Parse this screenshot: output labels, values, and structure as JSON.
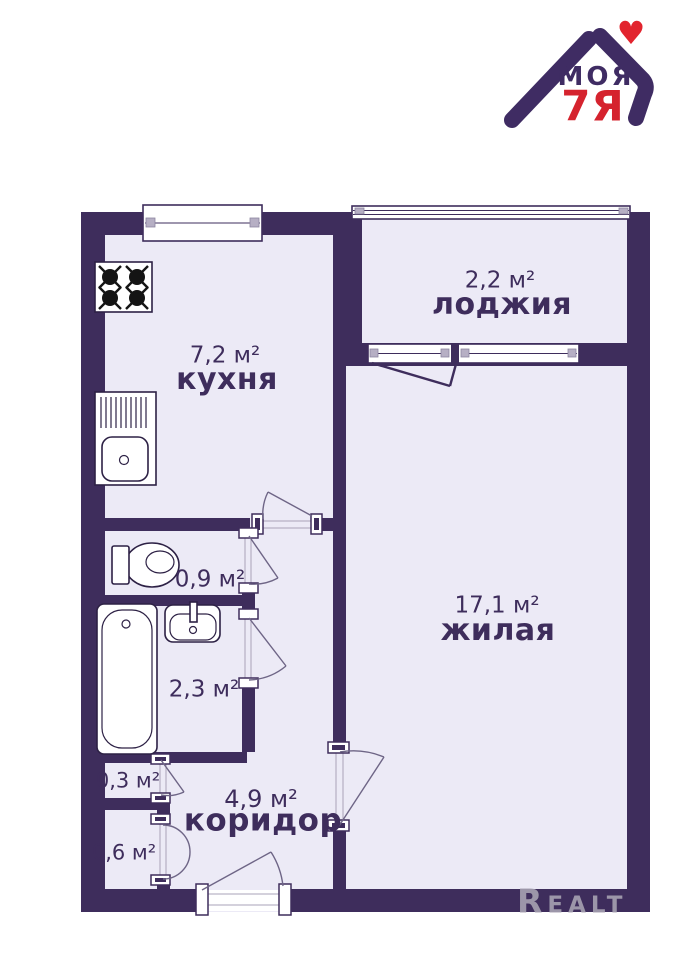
{
  "brand": {
    "word": "МОЯ",
    "mark": "7Я",
    "heart": "♥"
  },
  "watermark": {
    "text": "Realt"
  },
  "rooms": {
    "kitchen": {
      "area": "7,2 м²",
      "name": "кухня"
    },
    "loggia": {
      "area": "2,2 м²",
      "name": "лоджия"
    },
    "living": {
      "area": "17,1 м²",
      "name": "жилая"
    },
    "wc": {
      "area": "0,9 м²"
    },
    "bath": {
      "area": "2,3 м²"
    },
    "closet_small": {
      "area": "0,3 м²"
    },
    "closet_big": {
      "area": "0,6 м²"
    },
    "corridor": {
      "area": "4,9 м²",
      "name": "коридор"
    }
  },
  "colors": {
    "wall": "#3e2d5c",
    "room_fill": "#eceaf6",
    "brand_purple": "#3f2c63",
    "brand_red": "#d5232e",
    "watermark_gray": "#a59fb0"
  }
}
